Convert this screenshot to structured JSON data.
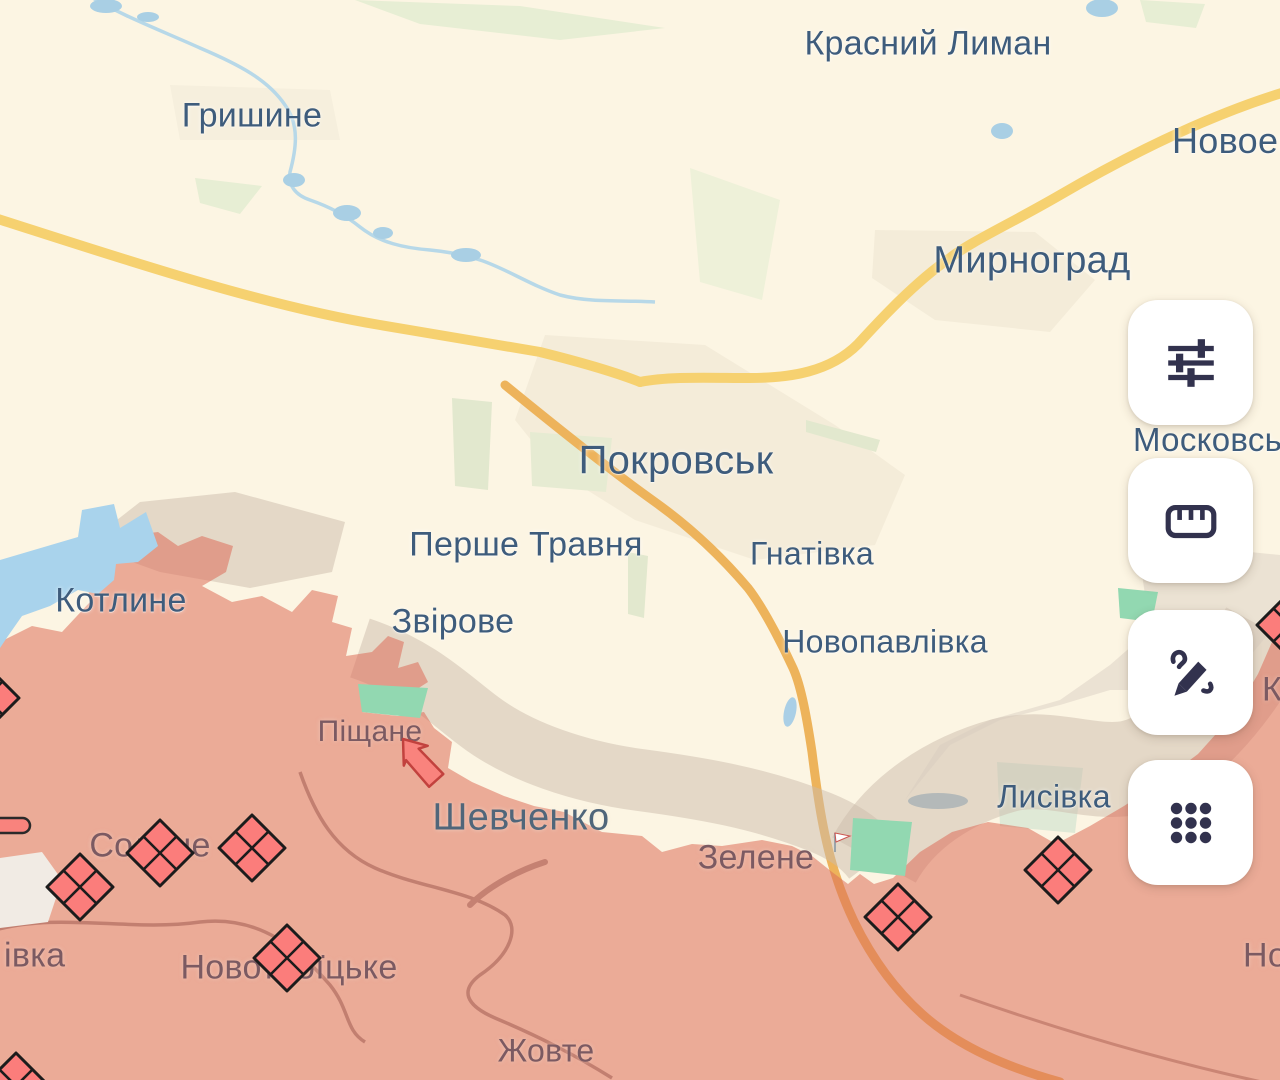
{
  "colors": {
    "bg_cream": "#fcf5e3",
    "occupied_overlay": "rgba(220,110,90,0.55)",
    "gray_zone_overlay": "rgba(203,188,172,0.5)",
    "kotlyne_blue": "#a9d3ec",
    "marker_red": "#fb7d7b",
    "marker_stroke": "#1c1c1c",
    "arrow_red": "#f9837d",
    "arrow_stroke": "#c2423e",
    "icon_navy": "#32324e",
    "road_yellow": "#f6d170",
    "road_orange": "#edb35b",
    "river_blue": "#b7d8e8",
    "label_blue": "#3e5c7c",
    "label_muted": "#7b5a62"
  },
  "toolbar": {
    "buttons": [
      {
        "id": "filters",
        "icon": "filters-sliders-icon",
        "top": 300
      },
      {
        "id": "ruler",
        "icon": "ruler-icon",
        "top": 458
      },
      {
        "id": "draw",
        "icon": "draw-pencil-icon",
        "top": 610
      },
      {
        "id": "apps",
        "icon": "apps-grid-icon",
        "top": 760
      }
    ]
  },
  "map": {
    "labels": [
      {
        "id": "krasnyi-lyman",
        "text": "Красний Лиман",
        "x": 928,
        "y": 44,
        "size": 34,
        "tone": "blue",
        "align": "center"
      },
      {
        "id": "hryshyne",
        "text": "Гришине",
        "x": 252,
        "y": 116,
        "size": 34,
        "tone": "blue",
        "align": "center"
      },
      {
        "id": "novoekonomichne",
        "text": "Новоекономічне",
        "x": 1172,
        "y": 141,
        "size": 36,
        "tone": "blue",
        "align": "left"
      },
      {
        "id": "myrnohrad",
        "text": "Мирноград",
        "x": 1032,
        "y": 261,
        "size": 38,
        "tone": "blue",
        "align": "center"
      },
      {
        "id": "moskovske",
        "text": "Московське",
        "x": 1133,
        "y": 440,
        "size": 33,
        "tone": "blue",
        "align": "left"
      },
      {
        "id": "pokrovsk",
        "text": "Покровськ",
        "x": 676,
        "y": 461,
        "size": 40,
        "tone": "blue",
        "align": "center"
      },
      {
        "id": "pershe-travnia",
        "text": "Перше Травня",
        "x": 526,
        "y": 545,
        "size": 34,
        "tone": "blue",
        "align": "center"
      },
      {
        "id": "hnativka",
        "text": "Гнатівка",
        "x": 812,
        "y": 554,
        "size": 32,
        "tone": "blue",
        "align": "center"
      },
      {
        "id": "kotlyne",
        "text": "Котлине",
        "x": 121,
        "y": 601,
        "size": 34,
        "tone": "blue",
        "align": "center"
      },
      {
        "id": "zvirove",
        "text": "Звірове",
        "x": 453,
        "y": 622,
        "size": 34,
        "tone": "blue",
        "align": "center"
      },
      {
        "id": "novopavlivka",
        "text": "Новопавлівка",
        "x": 885,
        "y": 642,
        "size": 32,
        "tone": "blue",
        "align": "center"
      },
      {
        "id": "pishchane",
        "text": "Піщане",
        "x": 370,
        "y": 732,
        "size": 30,
        "tone": "muted",
        "align": "center"
      },
      {
        "id": "shevchenko",
        "text": "Шевченко",
        "x": 521,
        "y": 818,
        "size": 38,
        "tone": "dim",
        "align": "center"
      },
      {
        "id": "lysivka",
        "text": "Лисівка",
        "x": 1054,
        "y": 797,
        "size": 32,
        "tone": "blue",
        "align": "center"
      },
      {
        "id": "zelene",
        "text": "Зелене",
        "x": 756,
        "y": 858,
        "size": 34,
        "tone": "muted",
        "align": "center"
      },
      {
        "id": "solone",
        "text": "Солоне",
        "x": 150,
        "y": 846,
        "size": 34,
        "tone": "muted",
        "align": "center"
      },
      {
        "id": "ivka-partial",
        "text": "івка",
        "x": 4,
        "y": 956,
        "size": 34,
        "tone": "muted",
        "align": "left"
      },
      {
        "id": "novotroitske",
        "text": "Новотроїцьке",
        "x": 289,
        "y": 968,
        "size": 34,
        "tone": "muted",
        "align": "center"
      },
      {
        "id": "zhovte",
        "text": "Жовте",
        "x": 546,
        "y": 1051,
        "size": 32,
        "tone": "muted",
        "align": "center"
      },
      {
        "id": "no-partial",
        "text": "Но",
        "x": 1243,
        "y": 956,
        "size": 34,
        "tone": "muted",
        "align": "left"
      },
      {
        "id": "k-partial",
        "text": "К",
        "x": 1262,
        "y": 690,
        "size": 34,
        "tone": "muted",
        "align": "left"
      }
    ],
    "markers": {
      "diamonds": [
        {
          "x": 160,
          "y": 853
        },
        {
          "x": 252,
          "y": 848
        },
        {
          "x": 80,
          "y": 887
        },
        {
          "x": 287,
          "y": 958
        },
        {
          "x": 898,
          "y": 917
        },
        {
          "x": 1058,
          "y": 870
        },
        {
          "x": -14,
          "y": 698
        },
        {
          "x": 1290,
          "y": 625
        },
        {
          "x": 16,
          "y": 1086
        }
      ],
      "arrow": {
        "tip_x": 403,
        "tip_y": 739,
        "rotation": -36
      },
      "flag": {
        "x": 835,
        "y": 838
      }
    }
  }
}
